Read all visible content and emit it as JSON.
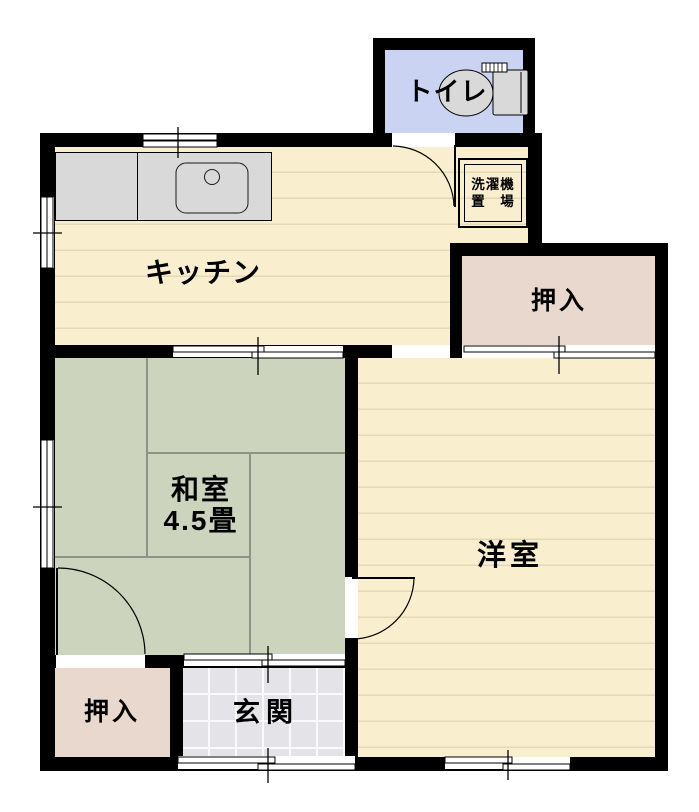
{
  "rooms": {
    "toilet": {
      "label": "トイレ"
    },
    "laundry": {
      "label_line1": "洗濯機",
      "label_line2": "置　場"
    },
    "kitchen": {
      "label": "キッチン"
    },
    "closet_upper": {
      "label": "押入"
    },
    "japanese_room": {
      "label": "和室",
      "size": "4.5畳"
    },
    "western_room": {
      "label": "洋室"
    },
    "closet_lower": {
      "label": "押入"
    },
    "entrance": {
      "label": "玄関"
    }
  },
  "colors": {
    "wall": "#000000",
    "wood_floor": "#f9efcf",
    "floor_line": "#e4d9b6",
    "tatami": "#cdd4bd",
    "tatami_line": "#8e9389",
    "closet": "#e9d8cd",
    "toilet_floor": "#cad3f1",
    "entrance_tile": "#e4e4e8",
    "tile_line": "#fafafa",
    "fixture": "#d9d9d9"
  }
}
